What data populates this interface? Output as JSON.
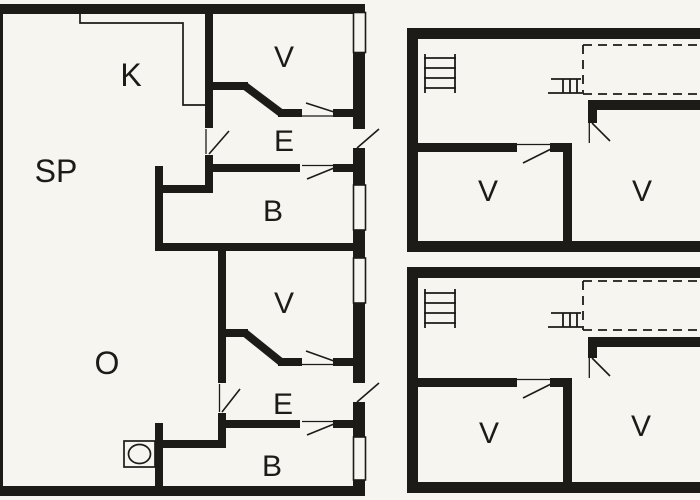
{
  "colors": {
    "wall": "#1d1b18",
    "bg": "#f6f5f0",
    "line": "#1d1b18"
  },
  "main_building": {
    "rooms": {
      "sp": "SP",
      "k": "K",
      "v_top": "V",
      "e_top": "E",
      "b_top": "B",
      "o": "O",
      "v_bottom": "V",
      "e_bottom": "E",
      "b_bottom": "B"
    }
  },
  "annex_upper": {
    "rooms": {
      "v_left": "V",
      "v_right": "V"
    }
  },
  "annex_lower": {
    "rooms": {
      "v_left": "V",
      "v_right": "V"
    }
  },
  "icons": {
    "stairs_upper_annex": "stairs-icon",
    "loft_ladder_upper_annex": "loft-ladder-icon",
    "stairs_lower_annex": "stairs-icon",
    "loft_ladder_lower_annex": "loft-ladder-icon",
    "stove": "stove-icon",
    "loft_outline_upper": "loft-dashed-outline",
    "loft_outline_lower": "loft-dashed-outline"
  }
}
